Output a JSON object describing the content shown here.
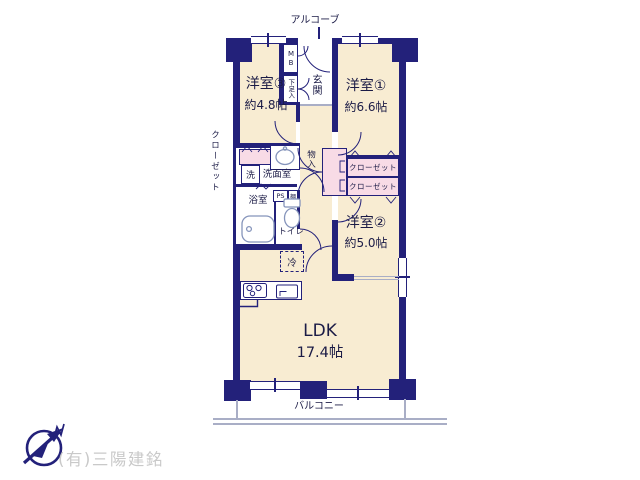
{
  "colors": {
    "wall": "#23217a",
    "room": "#f8ecd2",
    "closet": "#f8dbe6",
    "fixture": "#8594bb",
    "line": "#a9aec6",
    "company": "#c9c9c9"
  },
  "plan": {
    "alcove": "アルコーブ",
    "balcony": "バルコニー",
    "entrance": {
      "genkan": "玄関",
      "shoe_box": "下足入",
      "meter_box": "MB"
    },
    "rooms": {
      "western3": {
        "name": "洋室③",
        "size": "約4.8帖"
      },
      "western1": {
        "name": "洋室①",
        "size": "約6.6帖"
      },
      "western2": {
        "name": "洋室②",
        "size": "約5.0帖"
      },
      "ldk": {
        "name": "LDK",
        "size": "17.4帖"
      }
    },
    "storage": {
      "closet_side": "クローゼット",
      "closet_a": "クローゼット",
      "closet_b": "クローゼット",
      "storage_small": "物入",
      "shelf": "棚"
    },
    "wet_area": {
      "washroom": "洗面室",
      "washer": "洗",
      "bath": "浴室",
      "toilet": "トイレ",
      "pipe_space": "PS"
    },
    "kitchen": {
      "fridge": "冷"
    }
  },
  "footer": {
    "company": "(有)三陽建銘"
  }
}
